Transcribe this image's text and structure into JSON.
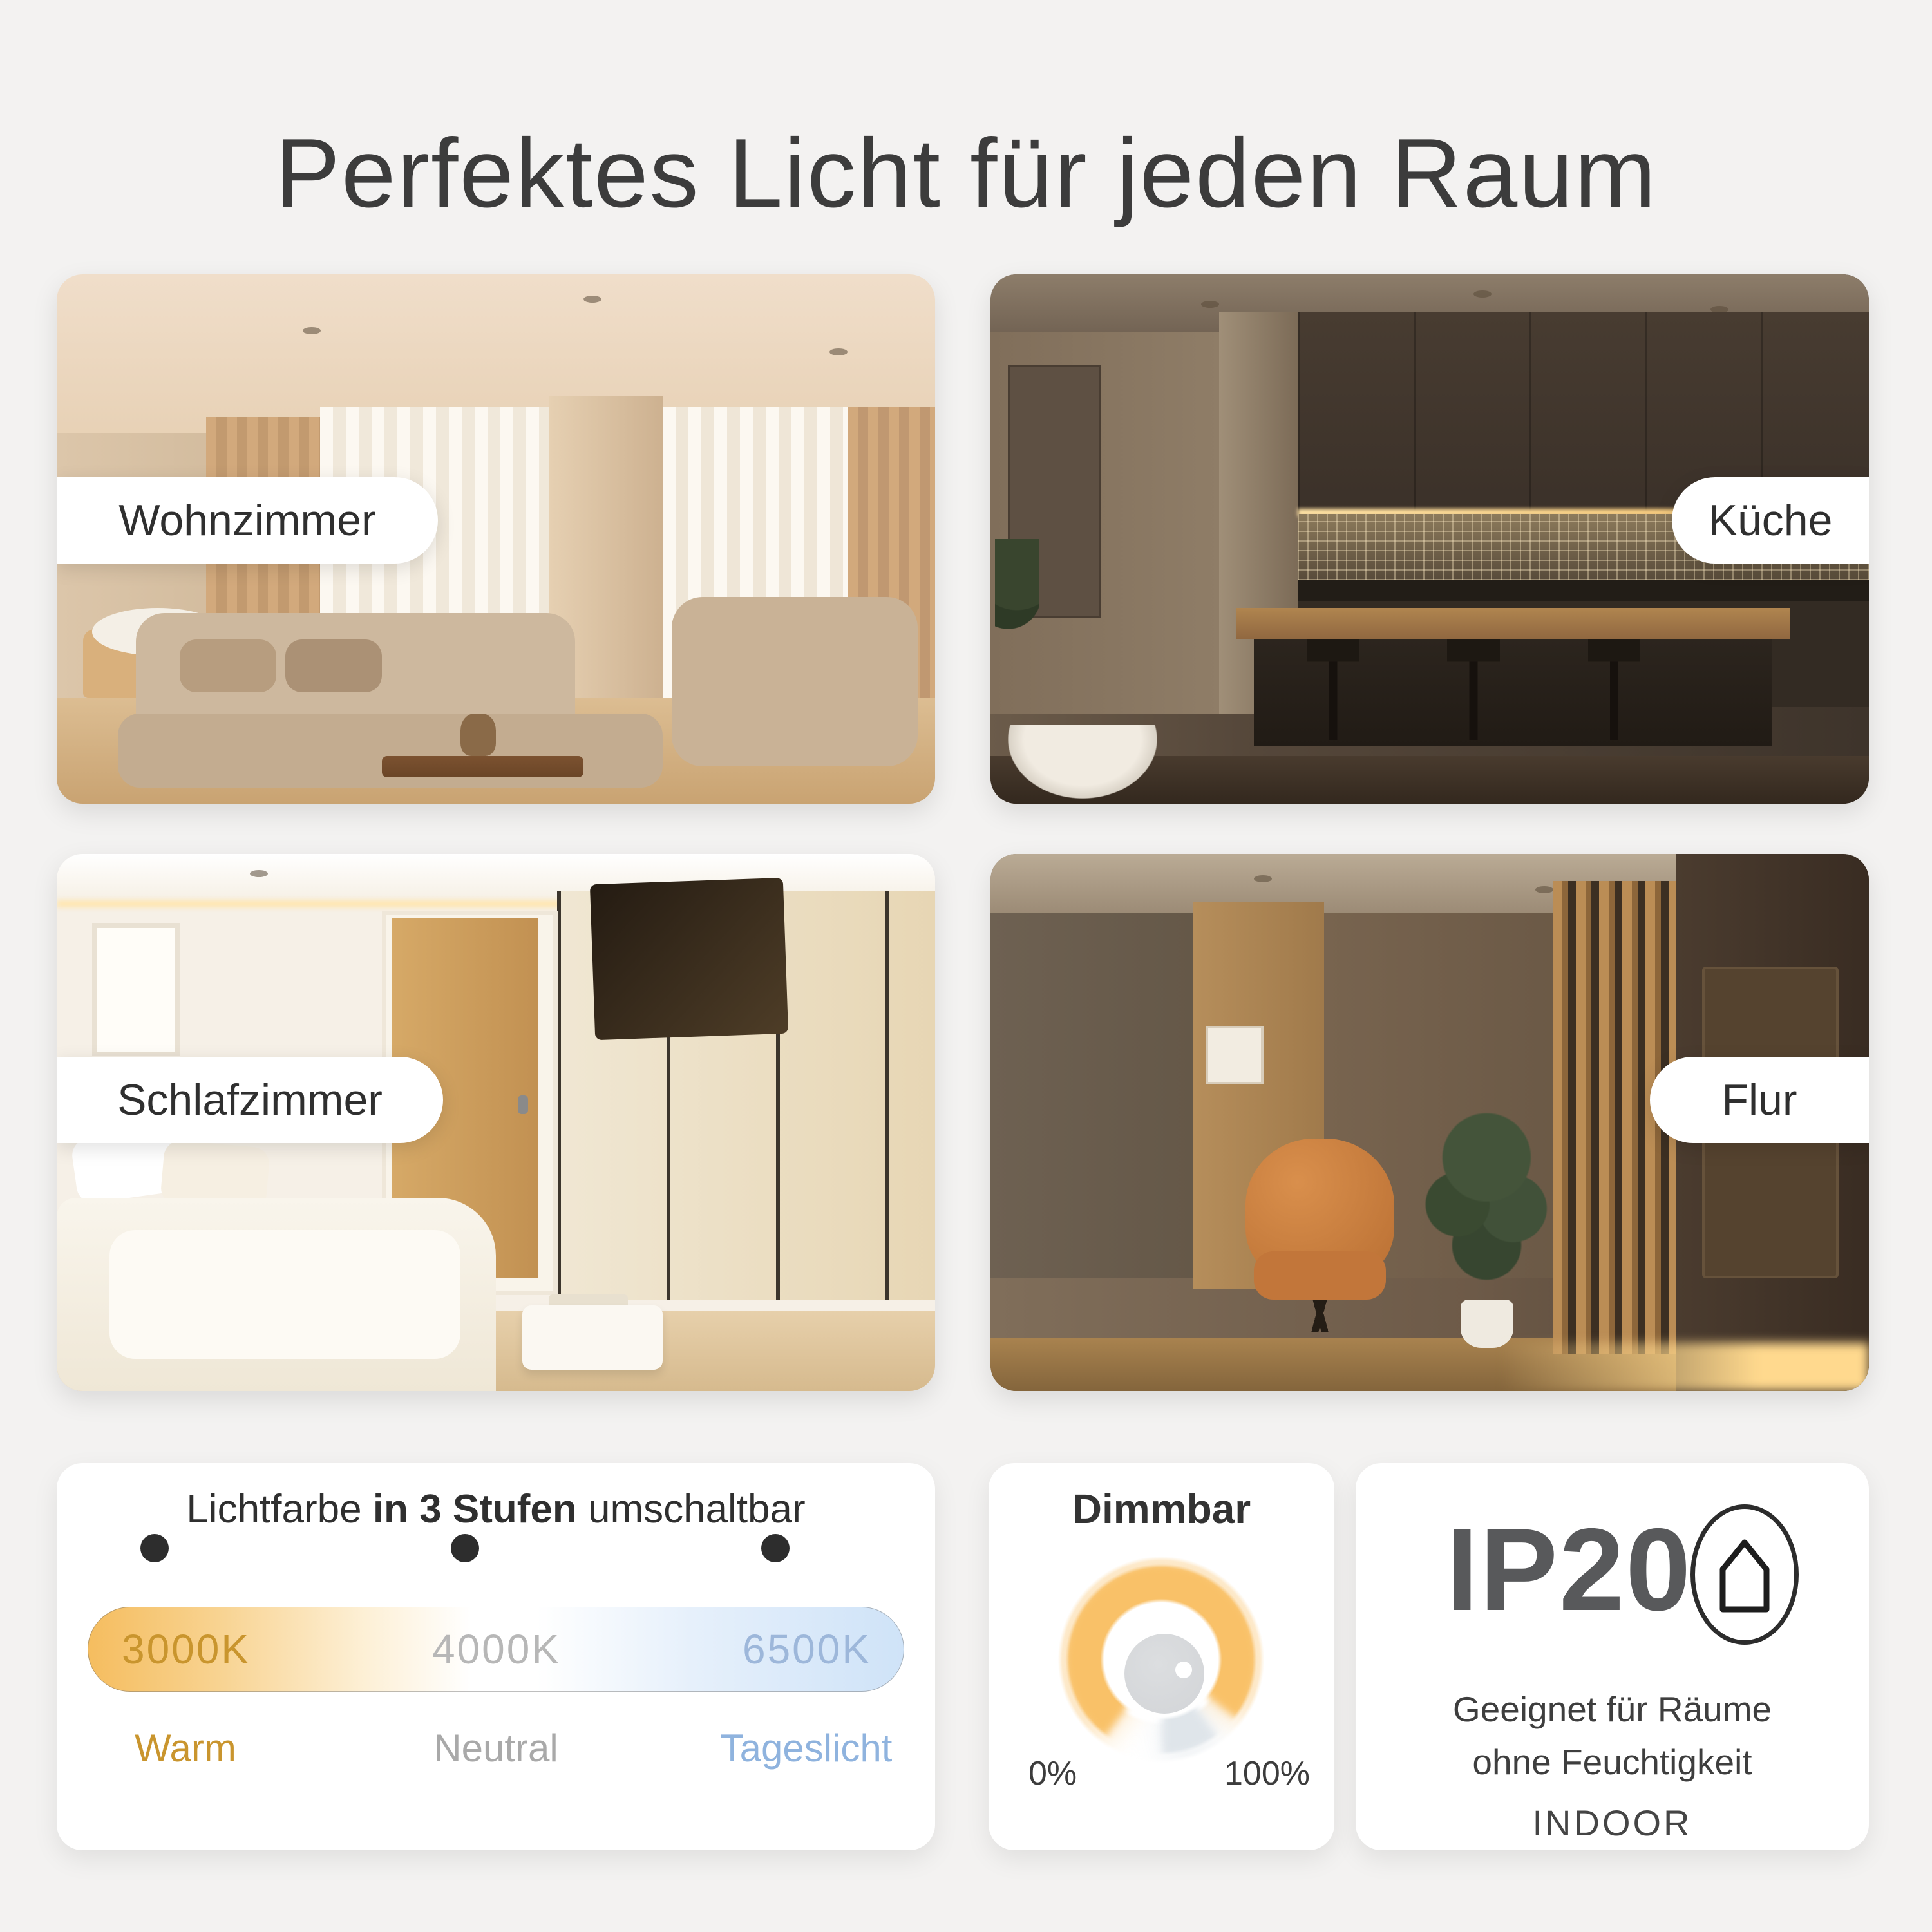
{
  "page": {
    "title": "Perfektes Licht für jeden Raum",
    "background_color": "#f3f2f1",
    "card_color": "#ffffff"
  },
  "rooms": [
    {
      "label": "Wohnzimmer",
      "position": "top-left"
    },
    {
      "label": "Küche",
      "position": "top-right"
    },
    {
      "label": "Schlafzimmer",
      "position": "bottom-left"
    },
    {
      "label": "Flur",
      "position": "bottom-right"
    }
  ],
  "light_color_card": {
    "heading_prefix": "Lichtfarbe",
    "heading_bold": " in 3 Stufen",
    "heading_suffix": " umschaltbar",
    "stops": [
      {
        "kelvin": "3000K",
        "label": "Warm",
        "color": "#c9952e"
      },
      {
        "kelvin": "4000K",
        "label": "Neutral",
        "color": "#a9a9a9"
      },
      {
        "kelvin": "6500K",
        "label": "Tageslicht",
        "color": "#8fb3de"
      }
    ],
    "gradient_colors": [
      "#f5bd5f",
      "#ffffff",
      "#cfe3f8"
    ],
    "dot_color": "#2d2d2d"
  },
  "dimmable_card": {
    "heading": "Dimmbar",
    "min_label": "0%",
    "max_label": "100%",
    "accent_color": "#f9c168",
    "knob_color": "#d4d6d9"
  },
  "ip_card": {
    "rating": "IP20",
    "icon": "house-icon",
    "description_line1": "Geeignet für Räume",
    "description_line2": "ohne Feuchtigkeit",
    "tag": "INDOOR"
  }
}
